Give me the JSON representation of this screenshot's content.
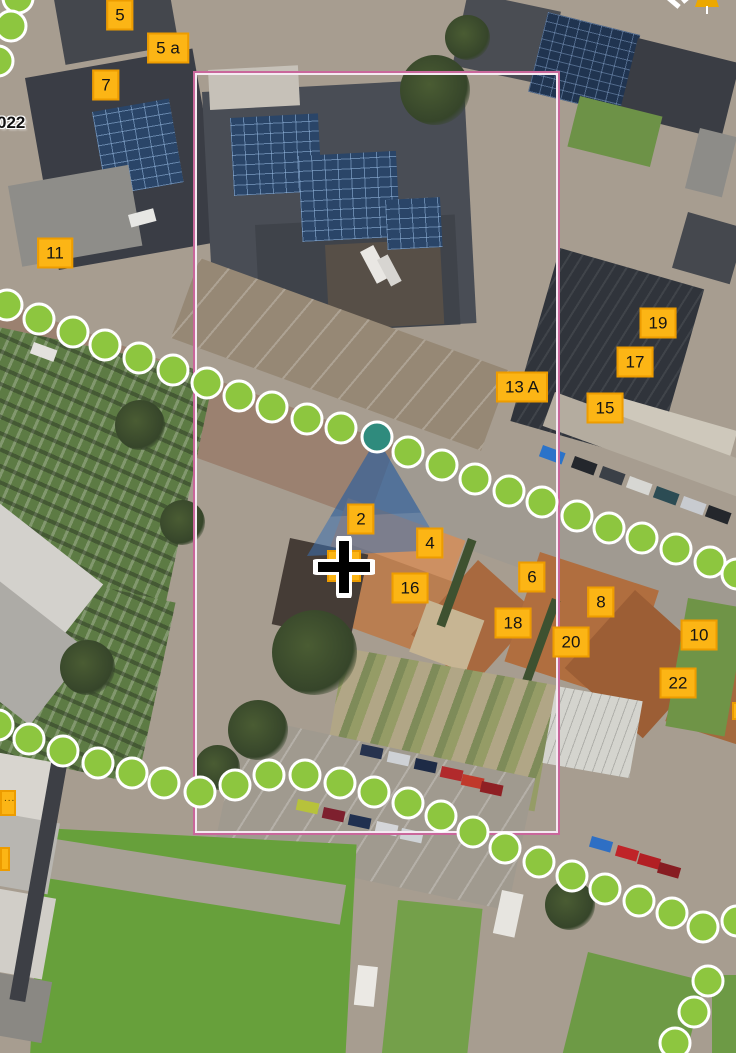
{
  "overlay": {
    "imagery_label": "022",
    "colors": {
      "label_bg": "#FCB515",
      "label_border": "#ED9C00",
      "label_text": "#141414",
      "dot_fill": "#8DC63F",
      "dot_ring": "#FFFFFF",
      "selected_fill": "#2F8B7D",
      "cone_blue": "#3B6FB0",
      "boundary_pink": "#C9679B",
      "boundary_inner": "#F5EAF2",
      "cross_black": "#000000",
      "cross_outline": "#FFFFFF",
      "marker_fragment_yellow": "#ECA800"
    },
    "boundary": {
      "left": 193,
      "top": 71,
      "width": 367,
      "height": 764
    },
    "view_cone": {
      "apex": [
        377,
        438
      ],
      "base_left": [
        307,
        556
      ],
      "base_right": [
        443,
        550
      ]
    },
    "selected_point": [
      377,
      437
    ],
    "crosshair": [
      344,
      567
    ],
    "address_labels": [
      {
        "text": "5",
        "x": 120,
        "y": 15
      },
      {
        "text": "5 a",
        "x": 168,
        "y": 48
      },
      {
        "text": "7",
        "x": 106,
        "y": 85
      },
      {
        "text": "11",
        "x": 55,
        "y": 253
      },
      {
        "text": "13 A",
        "x": 522,
        "y": 387
      },
      {
        "text": "19",
        "x": 658,
        "y": 323
      },
      {
        "text": "17",
        "x": 635,
        "y": 362
      },
      {
        "text": "15",
        "x": 605,
        "y": 408
      },
      {
        "text": "2",
        "x": 361,
        "y": 519
      },
      {
        "text": "4",
        "x": 430,
        "y": 543
      },
      {
        "text": "16",
        "x": 410,
        "y": 588
      },
      {
        "text": "6",
        "x": 532,
        "y": 577
      },
      {
        "text": "18",
        "x": 513,
        "y": 623
      },
      {
        "text": "8",
        "x": 601,
        "y": 602
      },
      {
        "text": "20",
        "x": 571,
        "y": 642
      },
      {
        "text": "10",
        "x": 699,
        "y": 635
      },
      {
        "text": "22",
        "x": 678,
        "y": 683
      },
      {
        "text": "",
        "x": 344,
        "y": 566,
        "w": 34,
        "h": 32
      }
    ],
    "partial_labels": [
      {
        "text": "....",
        "x": 0,
        "y": 790,
        "w": 16,
        "h": 26
      },
      {
        "text": "",
        "x": 0,
        "y": 847,
        "w": 9,
        "h": 24
      },
      {
        "text": "",
        "x": 732,
        "y": 702,
        "w": 4,
        "h": 18
      }
    ],
    "route_lines": [
      {
        "name": "upper-left-path",
        "points": [
          [
            18,
            -2
          ],
          [
            11,
            26
          ],
          [
            -2,
            61
          ]
        ]
      },
      {
        "name": "main-street-path",
        "points": [
          [
            7,
            305
          ],
          [
            39,
            319
          ],
          [
            73,
            332
          ],
          [
            105,
            345
          ],
          [
            139,
            358
          ],
          [
            173,
            370
          ],
          [
            207,
            383
          ],
          [
            239,
            396
          ],
          [
            272,
            407
          ],
          [
            307,
            419
          ],
          [
            341,
            428
          ],
          [
            408,
            452
          ],
          [
            442,
            465
          ],
          [
            475,
            479
          ],
          [
            509,
            491
          ],
          [
            542,
            502
          ],
          [
            577,
            516
          ],
          [
            609,
            528
          ],
          [
            642,
            538
          ],
          [
            676,
            549
          ],
          [
            710,
            562
          ],
          [
            737,
            574
          ]
        ]
      },
      {
        "name": "lower-path",
        "points": [
          [
            -2,
            725
          ],
          [
            29,
            739
          ],
          [
            63,
            751
          ],
          [
            98,
            763
          ],
          [
            132,
            773
          ],
          [
            164,
            783
          ],
          [
            200,
            792
          ],
          [
            235,
            785
          ],
          [
            269,
            775
          ],
          [
            305,
            775
          ],
          [
            340,
            783
          ],
          [
            374,
            792
          ],
          [
            408,
            803
          ],
          [
            441,
            816
          ],
          [
            473,
            832
          ],
          [
            505,
            848
          ],
          [
            539,
            862
          ],
          [
            572,
            876
          ],
          [
            605,
            889
          ],
          [
            639,
            901
          ],
          [
            672,
            913
          ],
          [
            703,
            927
          ],
          [
            737,
            921
          ]
        ]
      },
      {
        "name": "southeast-path",
        "points": [
          [
            708,
            981
          ],
          [
            694,
            1012
          ],
          [
            675,
            1043
          ]
        ]
      }
    ]
  }
}
